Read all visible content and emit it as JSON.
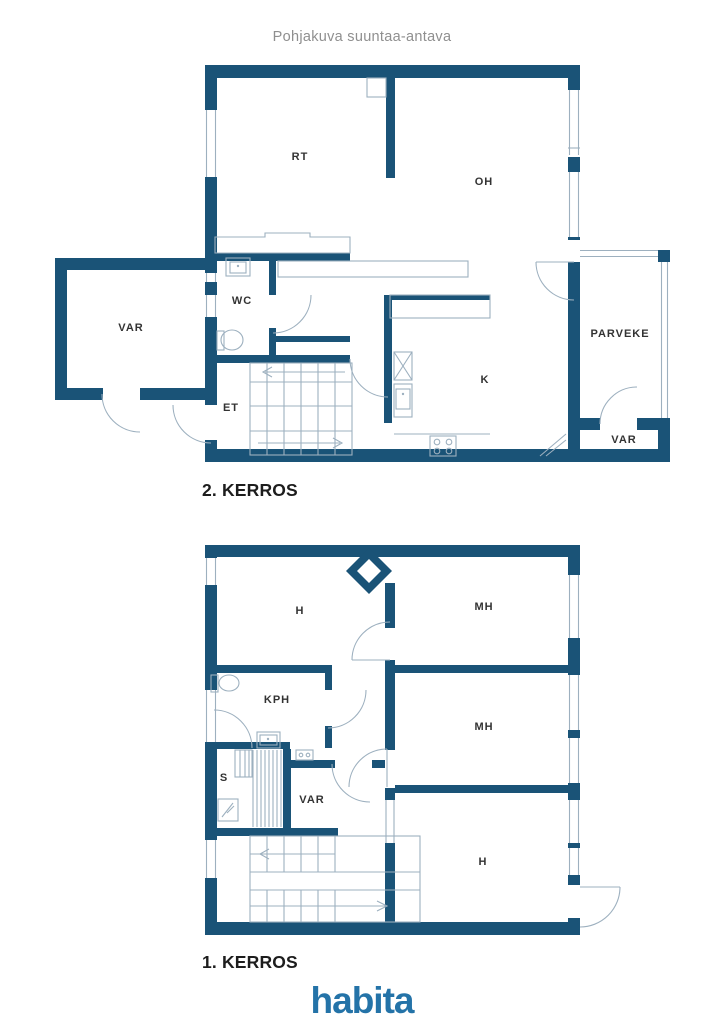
{
  "title": "Pohjakuva suuntaa-antava",
  "floor2": {
    "label": "2. KERROS",
    "rooms": {
      "rt": "RT",
      "oh": "OH",
      "var_annex": "VAR",
      "wc": "WC",
      "et": "ET",
      "k": "K",
      "parveke": "PARVEKE",
      "var_balcony": "VAR"
    }
  },
  "floor1": {
    "label": "1. KERROS",
    "rooms": {
      "h_top": "H",
      "mh_top": "MH",
      "mh_mid": "MH",
      "h_bottom": "H",
      "kph": "KPH",
      "s": "S",
      "var": "VAR"
    }
  },
  "logo": "habita",
  "colors": {
    "wall": "#1a5377",
    "thin_line": "#9db0bf",
    "logo_blue": "#2473a8",
    "room_label_text": "#333333",
    "floor_label_text": "#1d1d1d",
    "title_text": "#8f8f8f"
  }
}
